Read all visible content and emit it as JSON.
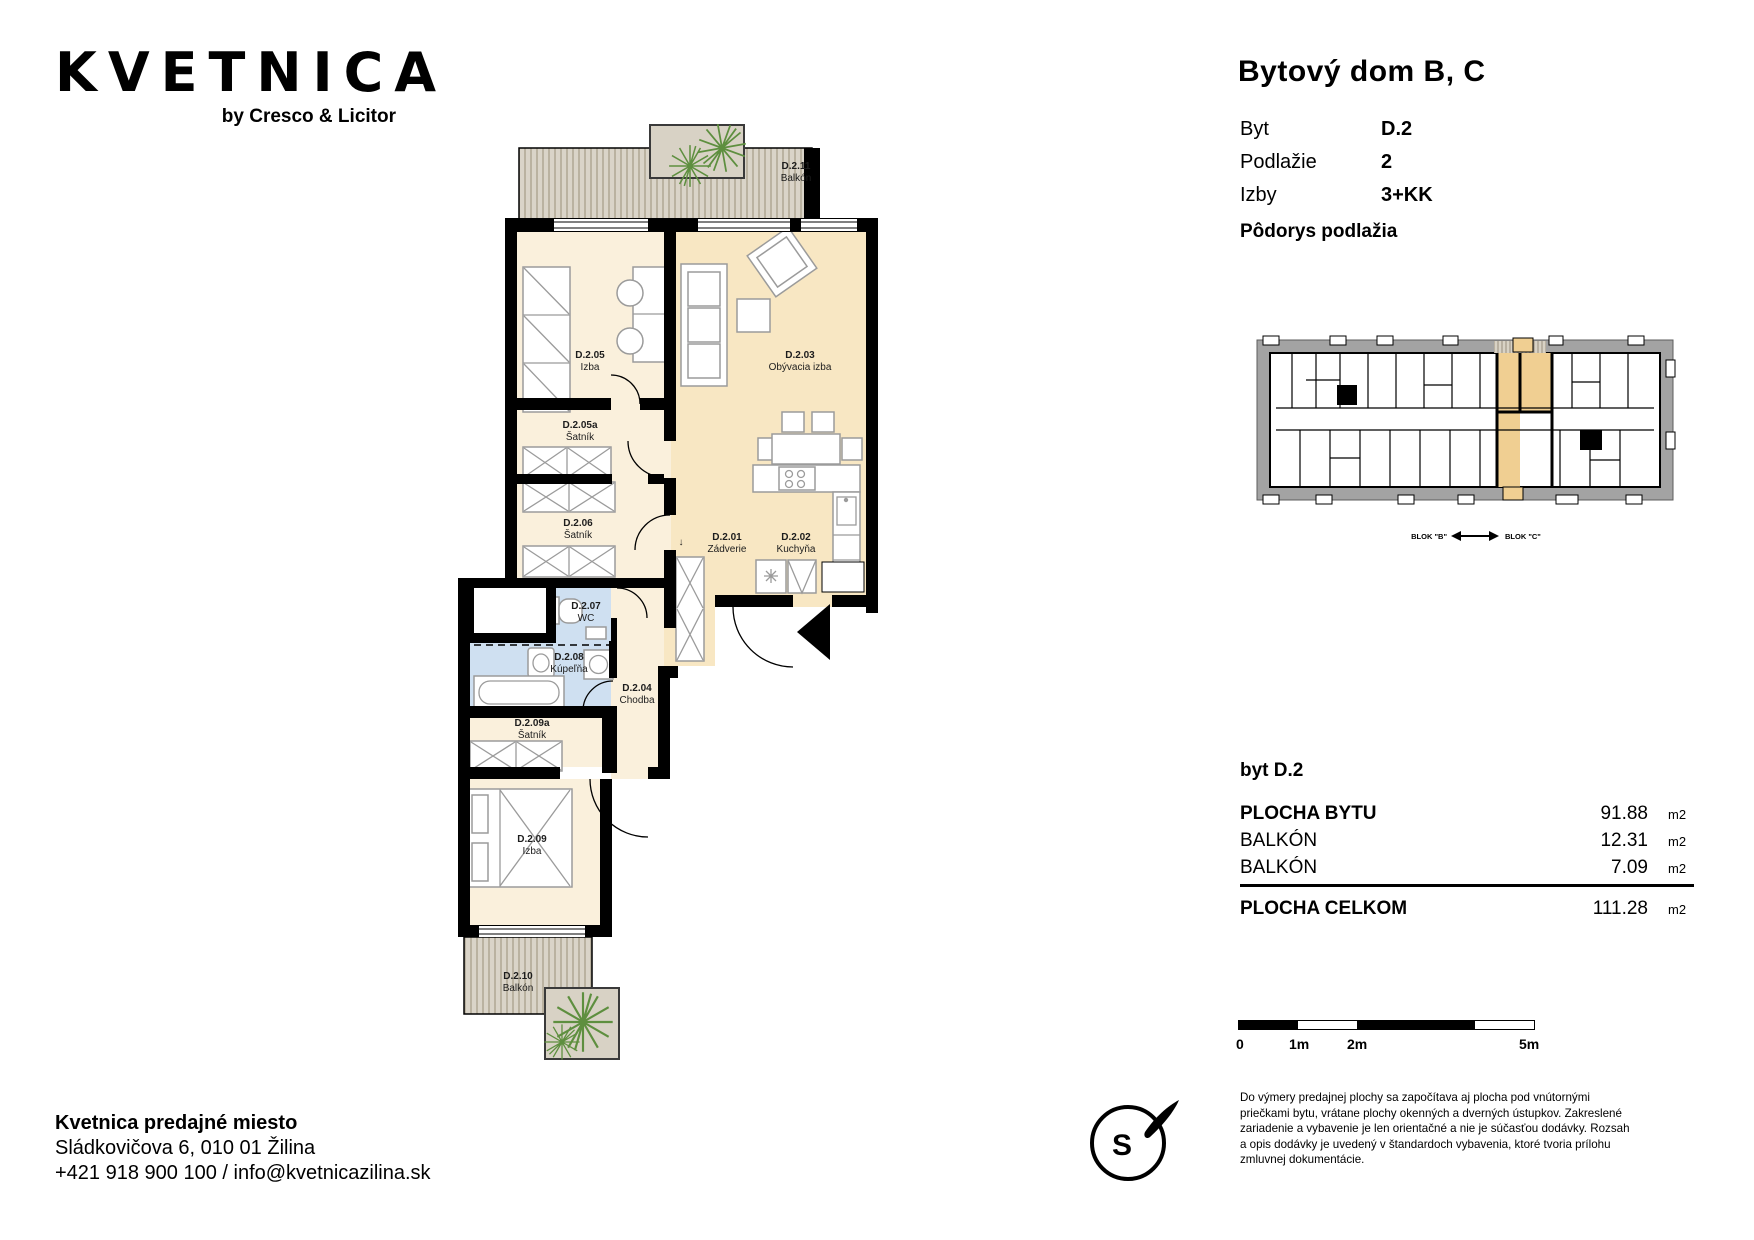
{
  "logo": {
    "brand": "KVETNICA",
    "byline": "by Cresco & Licitor"
  },
  "header": {
    "title": "Bytový dom B, C",
    "info": [
      {
        "label": "Byt",
        "value": "D.2"
      },
      {
        "label": "Podlažie",
        "value": "2"
      },
      {
        "label": "Izby",
        "value": "3+KK"
      }
    ],
    "floorplan_heading": "Pôdorys podlažia"
  },
  "overview": {
    "blok_left": "BLOK \"B\"",
    "blok_right": "BLOK \"C\""
  },
  "areas": {
    "heading": "byt D.2",
    "rows": [
      {
        "label": "PLOCHA BYTU",
        "value": "91.88",
        "unit": "m2"
      },
      {
        "label": "BALKÓN",
        "value": "12.31",
        "unit": "m2"
      },
      {
        "label": "BALKÓN",
        "value": "7.09",
        "unit": "m2"
      }
    ],
    "total": {
      "label": "PLOCHA CELKOM",
      "value": "111.28",
      "unit": "m2"
    }
  },
  "scalebar": {
    "labels": [
      "0",
      "1m",
      "2m",
      "5m"
    ]
  },
  "compass": {
    "letter": "S"
  },
  "disclaimer": {
    "0": "Do výmery predajnej plochy sa započítava aj plocha pod vnútornými",
    "1": "priečkami bytu, vrátane plochy okenných a dverných ústupkov. Zakreslené",
    "2": "zariadenie a vybavenie je len orientačné a nie je súčasťou dodávky. Rozsah",
    "3": "a opis dodávky je uvedený v štandardoch vybavenia, ktoré tvoria prílohu",
    "4": "zmluvnej dokumentácie."
  },
  "footer": {
    "name": "Kvetnica predajné miesto",
    "address": "Sládkovičova 6, 010 01 Žilina",
    "contact": "+421 918 900 100 / info@kvetnicazilina.sk"
  },
  "plan": {
    "down_arrow": "↓"
  },
  "rooms": [
    {
      "id": "D.2.01",
      "name": "Zádverie"
    },
    {
      "id": "D.2.02",
      "name": "Kuchyňa"
    },
    {
      "id": "D.2.03",
      "name": "Obývacia izba"
    },
    {
      "id": "D.2.04",
      "name": "Chodba"
    },
    {
      "id": "D.2.05",
      "name": "Izba"
    },
    {
      "id": "D.2.05a",
      "name": "Šatník"
    },
    {
      "id": "D.2.06",
      "name": "Šatník"
    },
    {
      "id": "D.2.07",
      "name": "WC"
    },
    {
      "id": "D.2.08",
      "name": "Kúpeľňa"
    },
    {
      "id": "D.2.09",
      "name": "Izba"
    },
    {
      "id": "D.2.09a",
      "name": "Šatník"
    },
    {
      "id": "D.2.10",
      "name": "Balkón"
    },
    {
      "id": "D.2.11",
      "name": "Balkón"
    }
  ],
  "colors": {
    "room_cream": "#FAF0DC",
    "room_tan": "#F8E7C3",
    "room_blue": "#CFE0F1",
    "balcony": "#D9D3C7",
    "highlight_orange": "#F0CF92",
    "plant_green": "#5E8F3F",
    "wall": "#000000"
  }
}
